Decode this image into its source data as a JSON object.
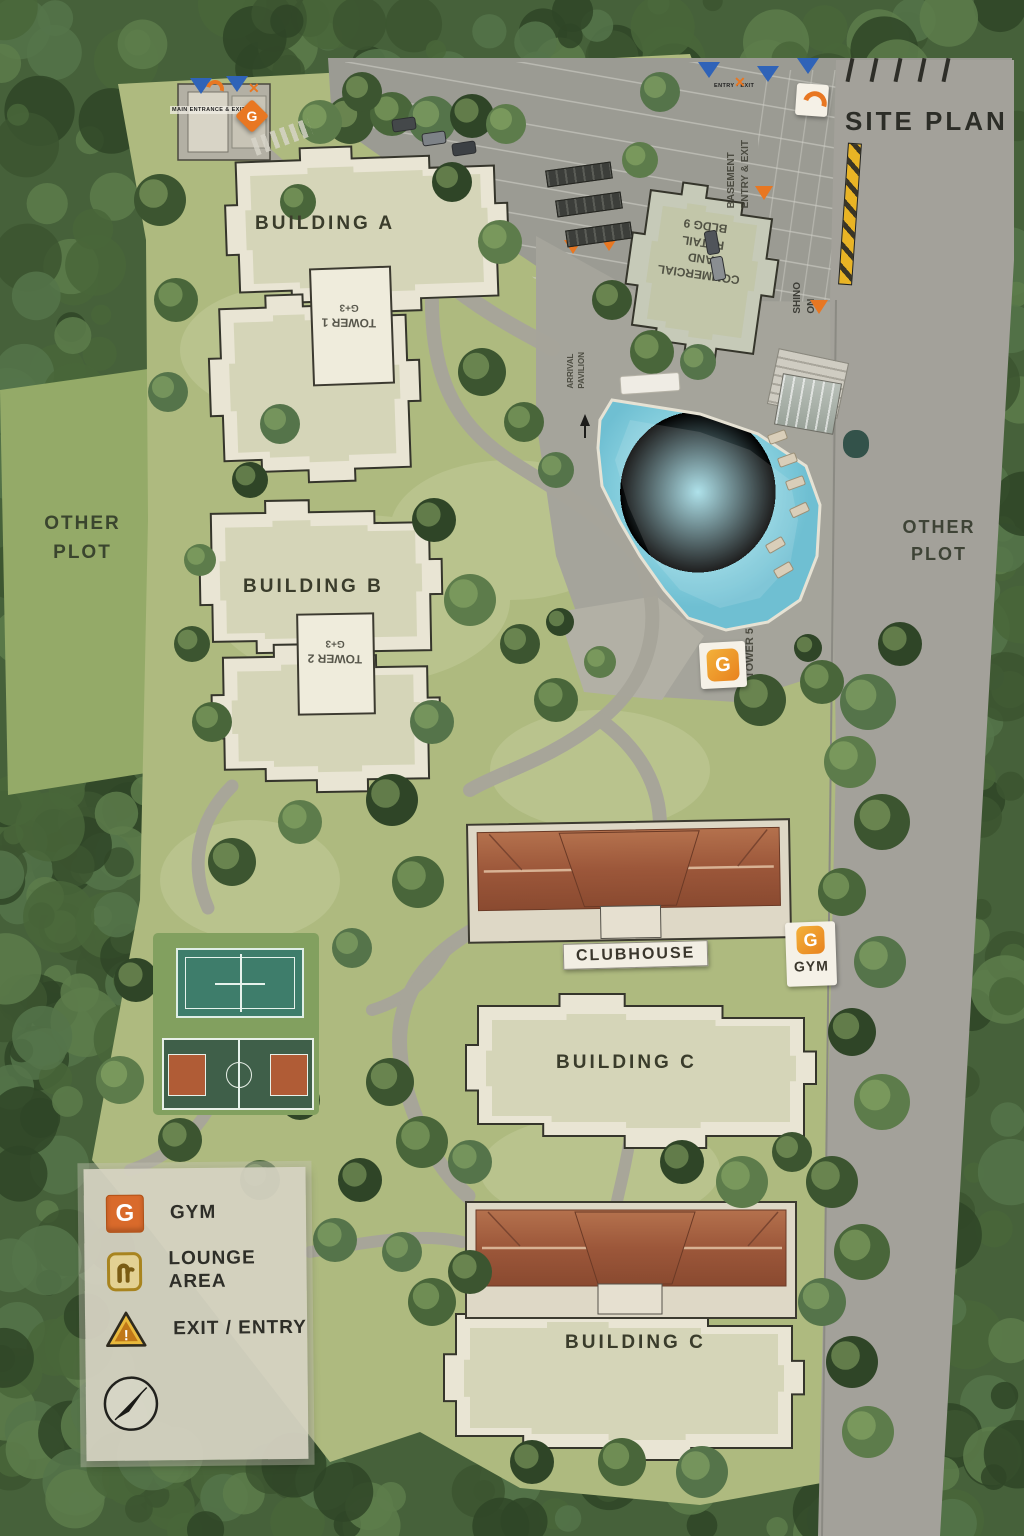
{
  "title": "SITE PLAN",
  "plots": {
    "left_line1": "OTHER",
    "left_line2": "PLOT",
    "right_line1": "OTHER",
    "right_line2": "PLOT"
  },
  "buildings": {
    "a": "BUILDING A",
    "b": "BUILDING B",
    "c_mid": "BUILDING C",
    "c_bottom": "BUILDING C",
    "clubhouse": "CLUBHOUSE",
    "commercial_line1": "COMMERCIAL AND",
    "commercial_line2": "RETAIL",
    "commercial_line3": "BLDG 9"
  },
  "towers": {
    "tower1_line1": "TOWER 1",
    "tower1_line2": "G+3",
    "tower2_line1": "TOWER 2",
    "tower2_line2": "G+3",
    "tower5": "TOWER 5"
  },
  "site_labels": {
    "basement_line1": "BASEMENT",
    "basement_line2": "ENTRY & EXIT",
    "ramp_line1": "ON",
    "ramp_line2": "SHINO",
    "arrival_line1": "ARRIVAL",
    "arrival_line2": "PAVILION",
    "gate_left": "MAIN ENTRANCE & EXIT",
    "gate_top": "ENTRY - EXIT"
  },
  "badges": {
    "gym_letter": "G",
    "gym_label": "GYM"
  },
  "legend": {
    "items": [
      {
        "icon": "gym-icon",
        "label": "GYM"
      },
      {
        "icon": "lounge-icon",
        "label": "LOUNGE AREA"
      },
      {
        "icon": "exit-entry-icon",
        "label": "EXIT / ENTRY"
      }
    ]
  },
  "colors": {
    "accent_orange": "#E87722",
    "marker_blue": "#2F63B8",
    "pool_blue": "#85CEDD",
    "roof_terracotta": "#A05A3D",
    "legend_gold": "#C9972E"
  }
}
